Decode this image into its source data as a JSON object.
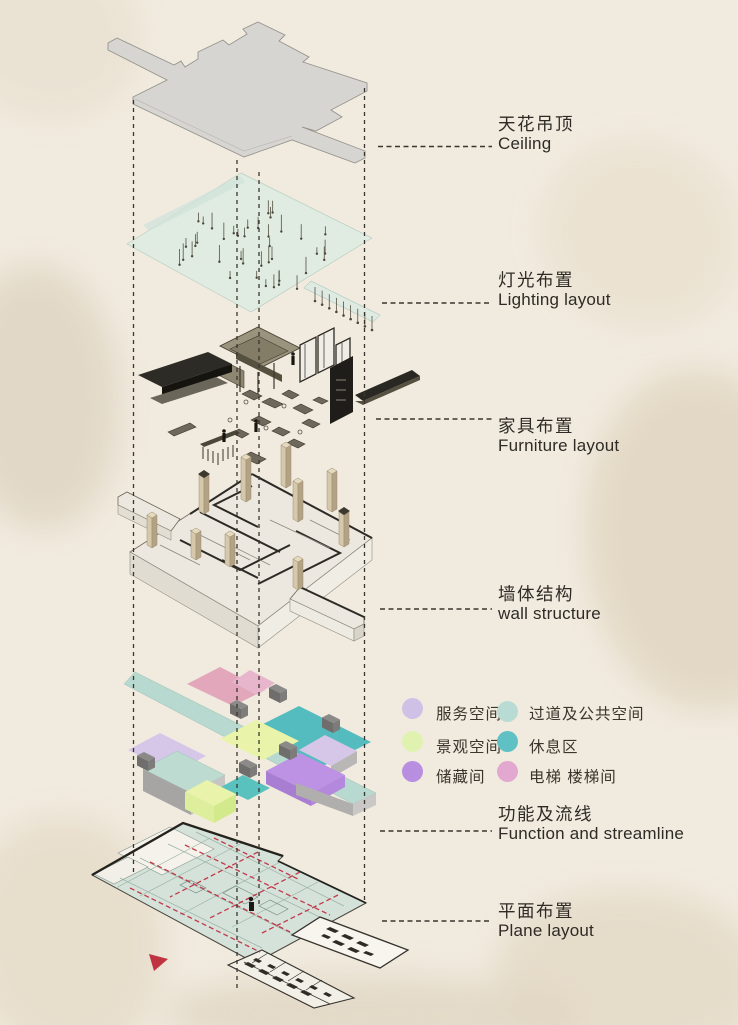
{
  "diagram": {
    "title": "exploded-axonometric-interior-design-diagram",
    "layers": [
      {
        "zh": "天花吊顶",
        "en": "Ceiling"
      },
      {
        "zh": "灯光布置",
        "en": "Lighting layout"
      },
      {
        "zh": "家具布置",
        "en": "Furniture layout"
      },
      {
        "zh": "墙体结构",
        "en": "wall structure"
      },
      {
        "zh": "功能及流线",
        "en": "Function and streamline"
      },
      {
        "zh": "平面布置",
        "en": "Plane layout"
      }
    ]
  },
  "legend": {
    "columns": [
      {
        "items": [
          {
            "label": "服务空间",
            "color": "#cfc1e6"
          },
          {
            "label": "景观空间",
            "color": "#e0f2b0"
          },
          {
            "label": "储藏间",
            "color": "#b78ee0"
          }
        ]
      },
      {
        "items": [
          {
            "label": "过道及公共空间",
            "color": "#b8dcd4"
          },
          {
            "label": "休息区",
            "color": "#5fc1c4"
          },
          {
            "label": "电梯 楼梯间",
            "color": "#e2a8cf"
          }
        ]
      }
    ]
  },
  "colors": {
    "background": "#f1ebdf",
    "ink": "#2e2b26",
    "flow_line_red": "#c2394a",
    "ceiling_gray": "#d6d5d2",
    "lighting_plane": "#dcebe3"
  }
}
